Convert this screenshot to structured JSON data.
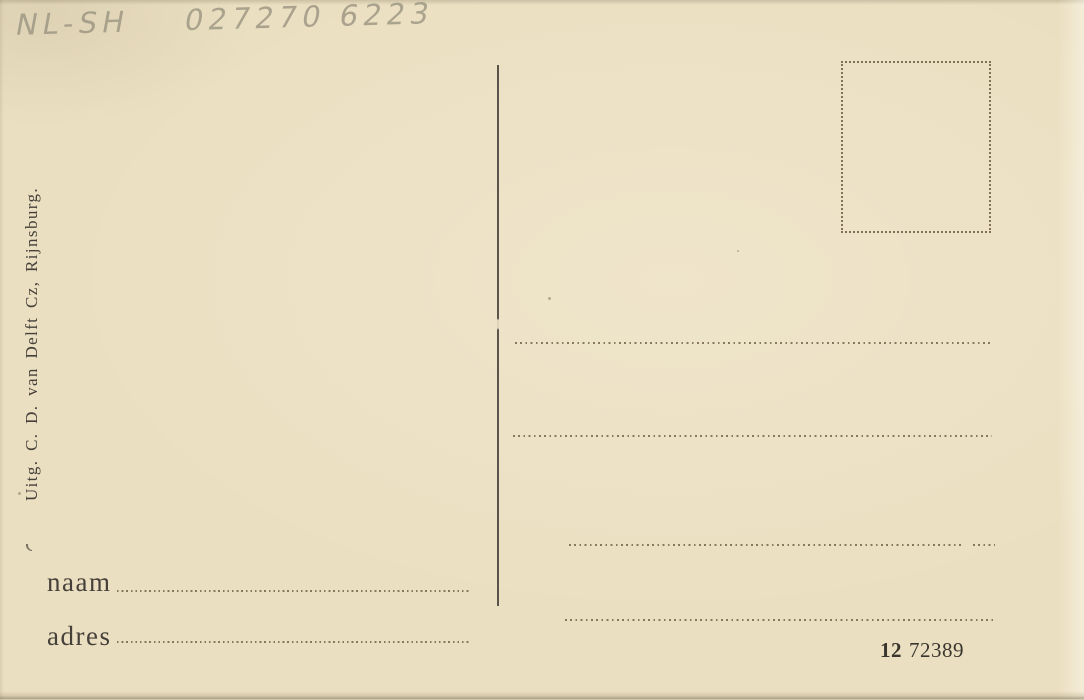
{
  "postcard": {
    "handwriting": {
      "code": "NL-SH",
      "number": "027270 6223"
    },
    "publisher": "Uitg. C. D. van Delft Cz, Rijnsburg.",
    "name_label": "naam",
    "address_label": "adres",
    "print_number": {
      "bold": "12",
      "regular": "72389"
    },
    "colors": {
      "paper": "#ebdfc1",
      "ink": "#46403a",
      "dots": "#75654c",
      "pencil": "#9a9481",
      "number-ink": "#3a362f"
    }
  }
}
